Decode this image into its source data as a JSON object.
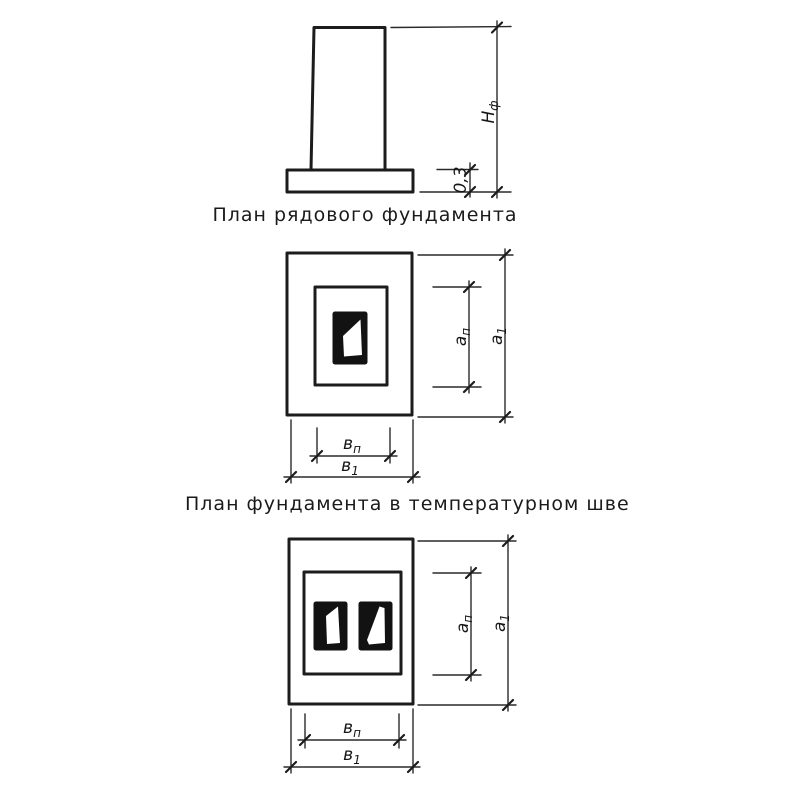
{
  "titles": {
    "plan_single": "План рядового фундамента",
    "plan_joint": "План фундамента в температурном шве"
  },
  "elevation": {
    "height_dim": {
      "main": "Н",
      "sub": "ф"
    },
    "base_thickness_dim": "0,3"
  },
  "plan_single": {
    "dim_an": {
      "main": "а",
      "sub": "п"
    },
    "dim_a1": {
      "main": "а",
      "sub": "1"
    },
    "dim_bn": {
      "main": "в",
      "sub": "п"
    },
    "dim_b1": {
      "main": "в",
      "sub": "1"
    }
  },
  "plan_joint": {
    "dim_an": {
      "main": "а",
      "sub": "п"
    },
    "dim_a1": {
      "main": "а",
      "sub": "1"
    },
    "dim_bn": {
      "main": "в",
      "sub": "п"
    },
    "dim_b1": {
      "main": "в",
      "sub": "1"
    }
  },
  "colors": {
    "line": "#1c1c1c",
    "background": "#ffffff"
  }
}
